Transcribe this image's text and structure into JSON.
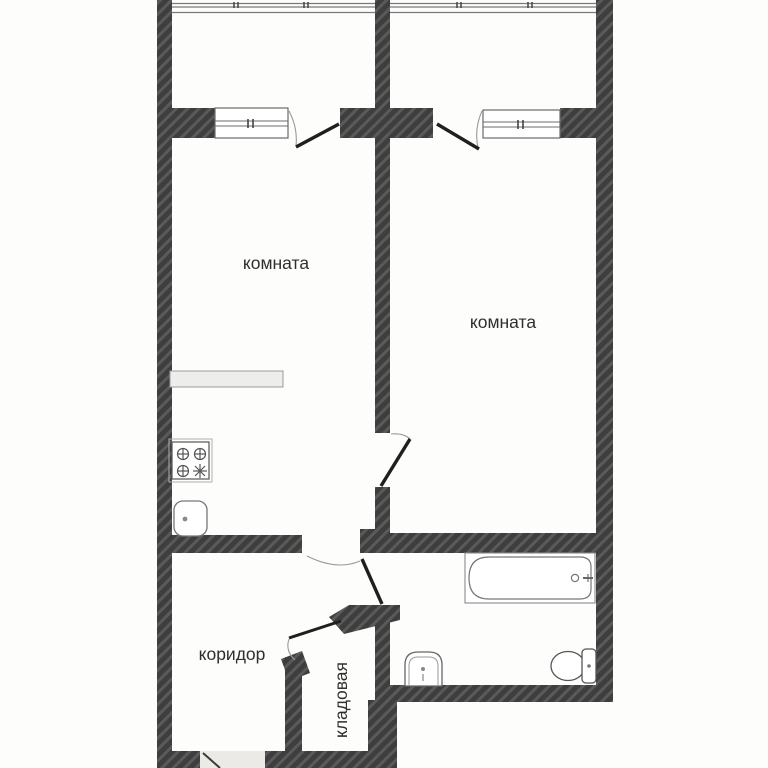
{
  "rooms": {
    "left": {
      "label": "комната"
    },
    "right": {
      "label": "комната"
    },
    "corridor": {
      "label": "коридор"
    },
    "storage": {
      "label": "кладовая"
    }
  },
  "fixtures": [
    "stove-icon",
    "kitchen-sink-icon",
    "counter",
    "bathtub-icon",
    "washbasin-icon",
    "toilet-icon",
    "balcony-railing-left",
    "balcony-railing-right",
    "entrance-door"
  ],
  "colors": {
    "wall_fill": "#3e3e3e",
    "wall_hatch": "#5a5a5a",
    "outline": "#666666",
    "door_leaf": "#1f1f1f",
    "swing_arc": "#9a9a9a",
    "counter_fill": "#ededeb",
    "entrance_fill": "#eceae7",
    "text": "#2f2f2f",
    "background": "#fdfdfb"
  }
}
